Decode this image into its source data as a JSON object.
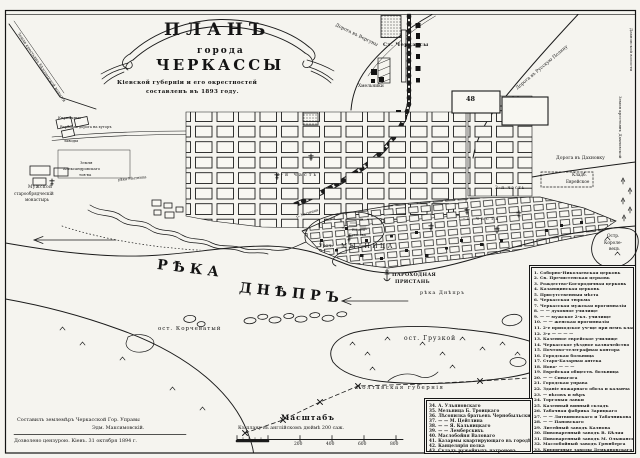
{
  "title": {
    "plan": "ПЛАНЪ",
    "goroda": "города",
    "city": "ЧЕРКАССЫ",
    "sub1": "Кіевской губерніи и его окрестностей",
    "sub2": "составленъ въ 1893 году."
  },
  "roads": {
    "verguny": "Дорога въ Вергуны",
    "russkaya_polyana": "Дорога въ Русскую Поляну",
    "dakhnovka": "Дорога въ Дахновку",
    "verbovaya": "Вербовая дорога на хуторъ"
  },
  "railway": {
    "station": "Ст. Черкассы"
  },
  "areas": {
    "khmelniki": "Хмельники",
    "kirpichnye": "Кирпичные",
    "zavody": "заводы",
    "zemlya1": "Земля",
    "zemlya2": "Александровскаго",
    "zemlya3": "тов-ва",
    "mon1": "Мужской",
    "mon2": "старообрядческій",
    "mon3": "монастырь",
    "left_volost": "Земля крестьянъ Бѣлозерской волости",
    "right_volost": "Земля крестьянъ Дахновской",
    "dakh_volost": "Дахновской волости",
    "cemetery1": "Кладб.",
    "cemetery2": "Еврейское",
    "part1": "1-я часть",
    "part2": "2-я часть",
    "part3": "3-я часть",
    "block48": "48"
  },
  "water": {
    "reka_big": "РѢКА",
    "dnepr_big": "ДНѢПРЪ",
    "reka_dnepr": "рѣка Днѣпръ",
    "mytnitsa_w": "рѣка Мытница",
    "mytnitsa_r": "р. Мытница",
    "uroch": "Уроч.",
    "mytnitsa": "МЫТНИЦА",
    "boloto1": "Болото",
    "boloto2": "Бугаевка",
    "pier1": "ПАРОХОДНАЯ",
    "pier2": "ПРИСТАНЬ"
  },
  "islands": {
    "korchevaty": "ост. Корчеватый",
    "gruzkoy": "ост. Грузкой",
    "kor1": "Остр.",
    "kor2": "Короле-",
    "kor3": "вецъ"
  },
  "boundary": {
    "poltava": "Полтавская губернія"
  },
  "scale": {
    "title": "Масштабъ",
    "caption": "Къ плану въ англійскомъ дюймѣ 200 саж.",
    "ticks": [
      "200",
      "400",
      "600",
      "800"
    ]
  },
  "credits": {
    "line1": "Составилъ землемѣръ Черкасской Гор. Управы",
    "line2": "Эдм. Максимовскій.",
    "line3": "Дозволено цензурою. Кіевъ. 31 октября 1894 г."
  },
  "legend": {
    "col1": [
      "1. Соборно-Николаевская церковь",
      "2. Св. Пречистенская церковь",
      "3. Рождество-Богородичная церковь",
      "4. Казанщинская церковь",
      "5. Присутственныя мѣста",
      "6. Черкасская тюрьма",
      "7. Черкасская мужская прогимназія",
      "8. — — духовное училище",
      "9. — — мужское 2-кл. училище",
      "10. — — женская прогимназія",
      "11. 2-е приходское уч-ще при немъ классы",
      "12. 3-е — — — —",
      "13. Казенное еврейское училище",
      "14. Черкасское уѣздное казначейство",
      "15. Почтово-телеграфная контора",
      "16. Городская больница",
      "17. Старо-Базарная аптека",
      "18. Ново- — — —",
      "19. Еврейская обществ. больница",
      "20. — — Синагога",
      "21. Городская управа",
      "22. Зданіе пожарнаго обоза и каланча",
      "23. — вѣсовъ и мѣръ",
      "24. Торговыя лавки",
      "25. Казенный винный складъ",
      "26. Табачная фабрика Зарицкаго",
      "27. — — Литвиновскаго и Табачникова",
      "28. — — Пановскаго",
      "29. Литейный заводъ Калнова",
      "30. Пивоваренный заводъ В. Бѣляя",
      "31. Пивоваренный заводъ М. Ольшанскаго",
      "32. Маслобойный заводъ Грюнберга",
      "33. Кирпичные заводы Демьяновскаго"
    ],
    "col2": [
      "34. А. Ульяновскаго",
      "35. Мельница Б. Троицкаго",
      "36. Лѣсопилка братьевъ Чернобыльскихъ",
      "37. — — М. Цейтлина",
      "38. — — Я. Кальницкаго",
      "39. — — Лемберскихъ",
      "40. Маслобойня Валоваго",
      "41. Казармы квартирующаго въ городѣ полка",
      "42. Канцелярія полка",
      "43. Складъ ружейныхъ патроновъ"
    ]
  }
}
